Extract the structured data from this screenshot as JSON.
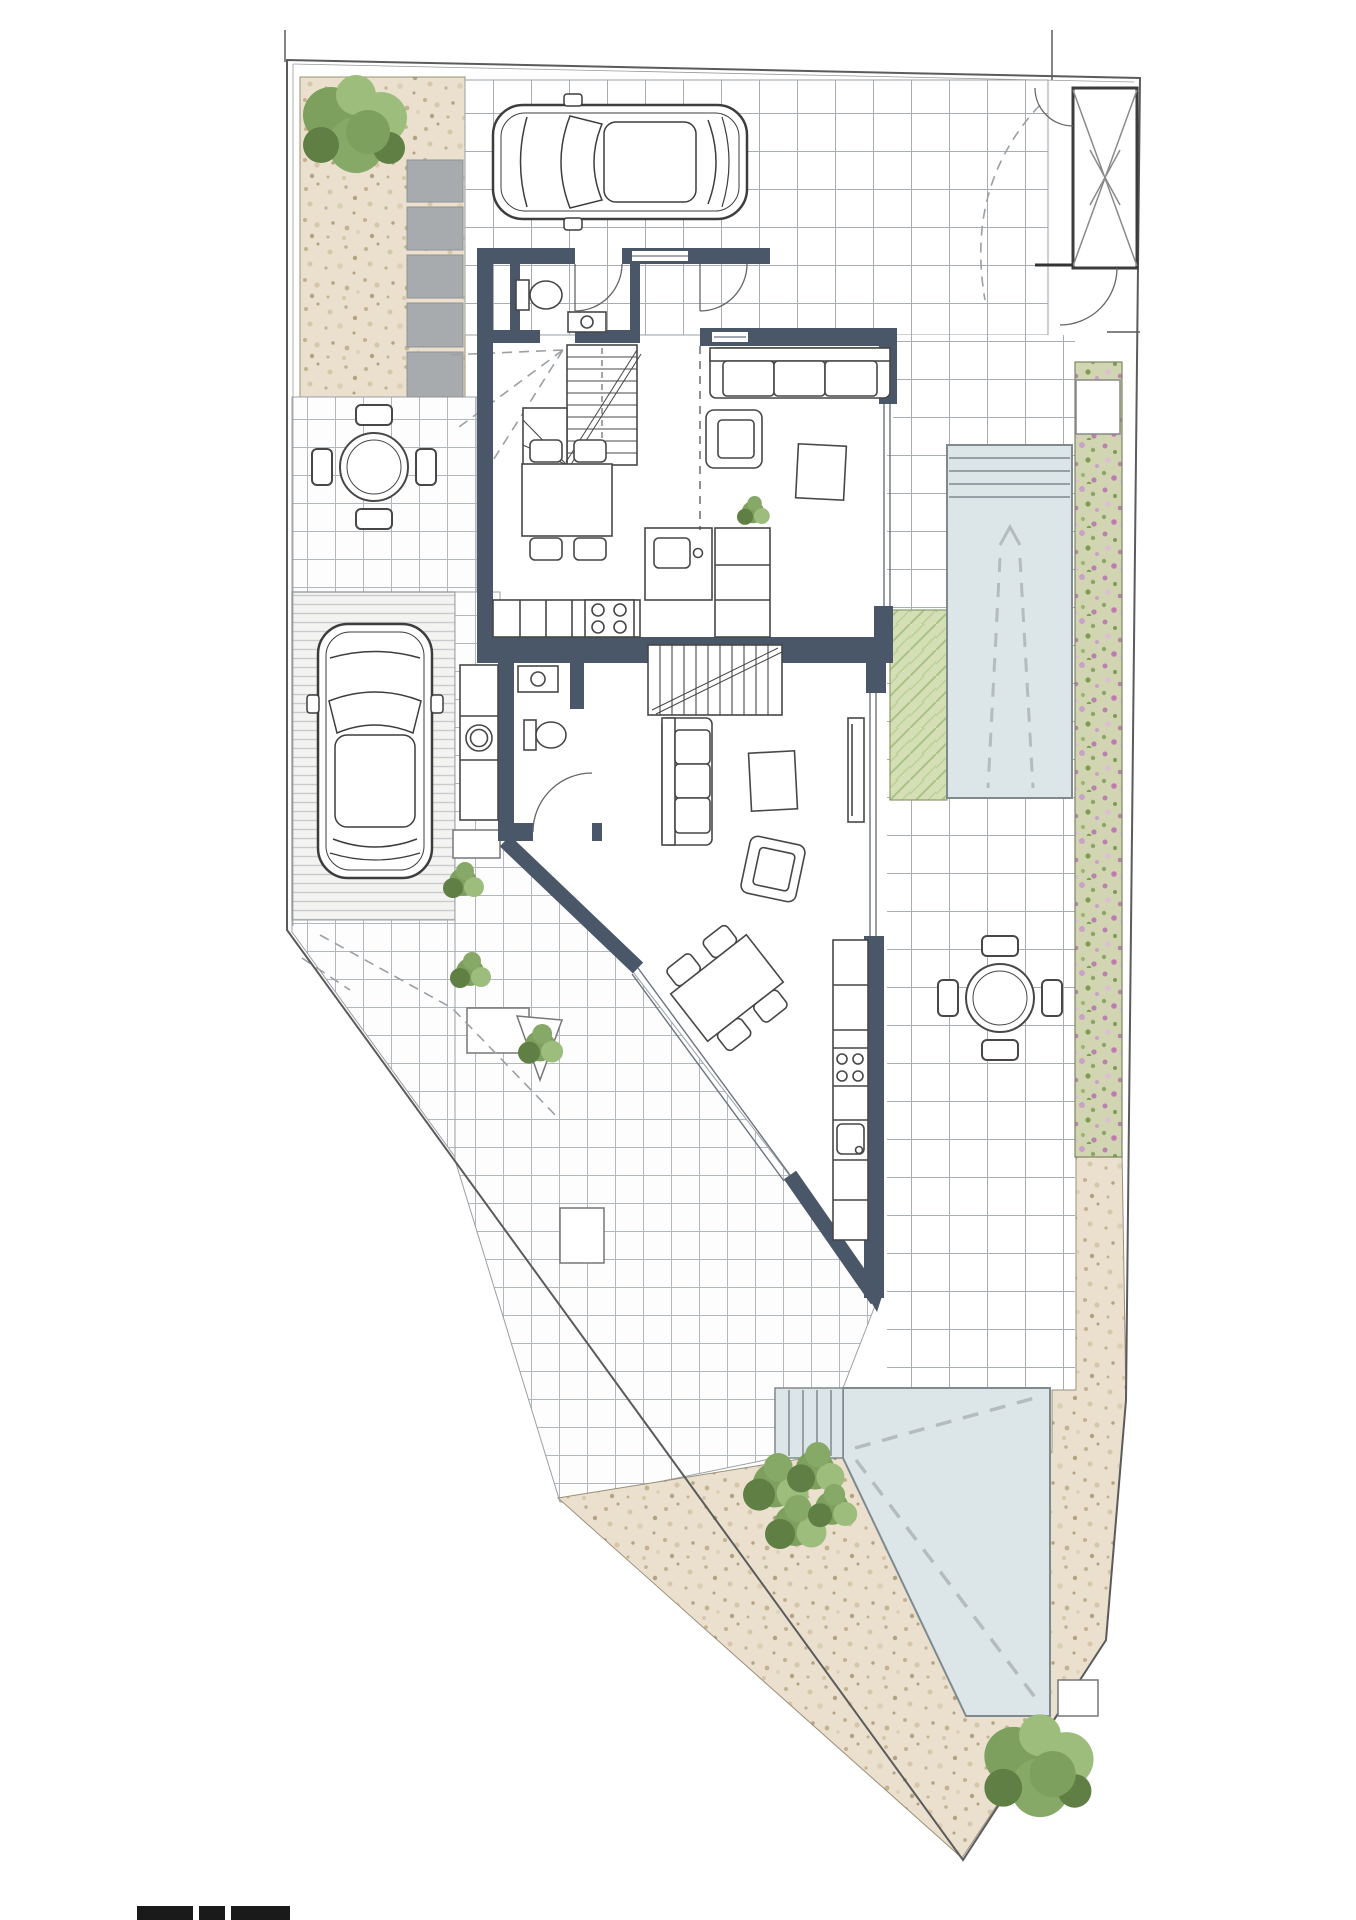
{
  "canvas": {
    "width": 1356,
    "height": 1920,
    "background": "#ffffff"
  },
  "palette": {
    "paper": "#ffffff",
    "wall": "#4a5768",
    "boundary": "#5b5b5b",
    "tile_line": "#a7adb2",
    "pool_fill": "#dce5e8",
    "pool_edge": "#7e8a8e",
    "pool_marking": "#b4bcbf",
    "gravel_base": "#eae0cd",
    "gravel_speck": "#c4b291",
    "grass_base": "#d4dfb6",
    "flower_base": "#d2d5b2",
    "flower_pink": "#b583ab",
    "stone": "#a7abae",
    "furniture_line": "#474747",
    "glass_line": "#6b7480",
    "guide_dash": "#9aa0a4",
    "tree_dark": "#5f7f45",
    "tree_mid": "#7da05e",
    "tree_light": "#9dbd7d",
    "scale_bar": "#1a1a1a"
  },
  "drawing": {
    "type": "architectural site / ground floor plan",
    "plot_shape": "irregular polygon tapering to a point at the south",
    "units": 2,
    "areas": [
      "gravel-bed-northwest",
      "stepping-stones",
      "north-driveway-tiles",
      "northeast-patio-tiles",
      "entry-enclosure",
      "west-patio-tiles",
      "west-driveway",
      "lap-pool-east",
      "flower-border-east",
      "grass-strip",
      "southeast-patio-tiles",
      "south-pool",
      "south-gravel-border",
      "scale-bar"
    ]
  },
  "landscape": {
    "trees": 2,
    "bushes": 6,
    "pools": 2,
    "stepping_stones": 5,
    "planters": 4
  },
  "vehicles": {
    "cars": 2
  },
  "furniture": {
    "round_patio_tables": 2,
    "dining_tables": 2,
    "sofas": 2,
    "armchairs": 2,
    "coffee_tables": 2,
    "staircases": 2,
    "toilets": 2,
    "washbasins": 3,
    "washing_machines": 1,
    "cooktops": 2,
    "kitchen_islands": 1,
    "tv_boards": 1,
    "indoor_plants": 1
  }
}
